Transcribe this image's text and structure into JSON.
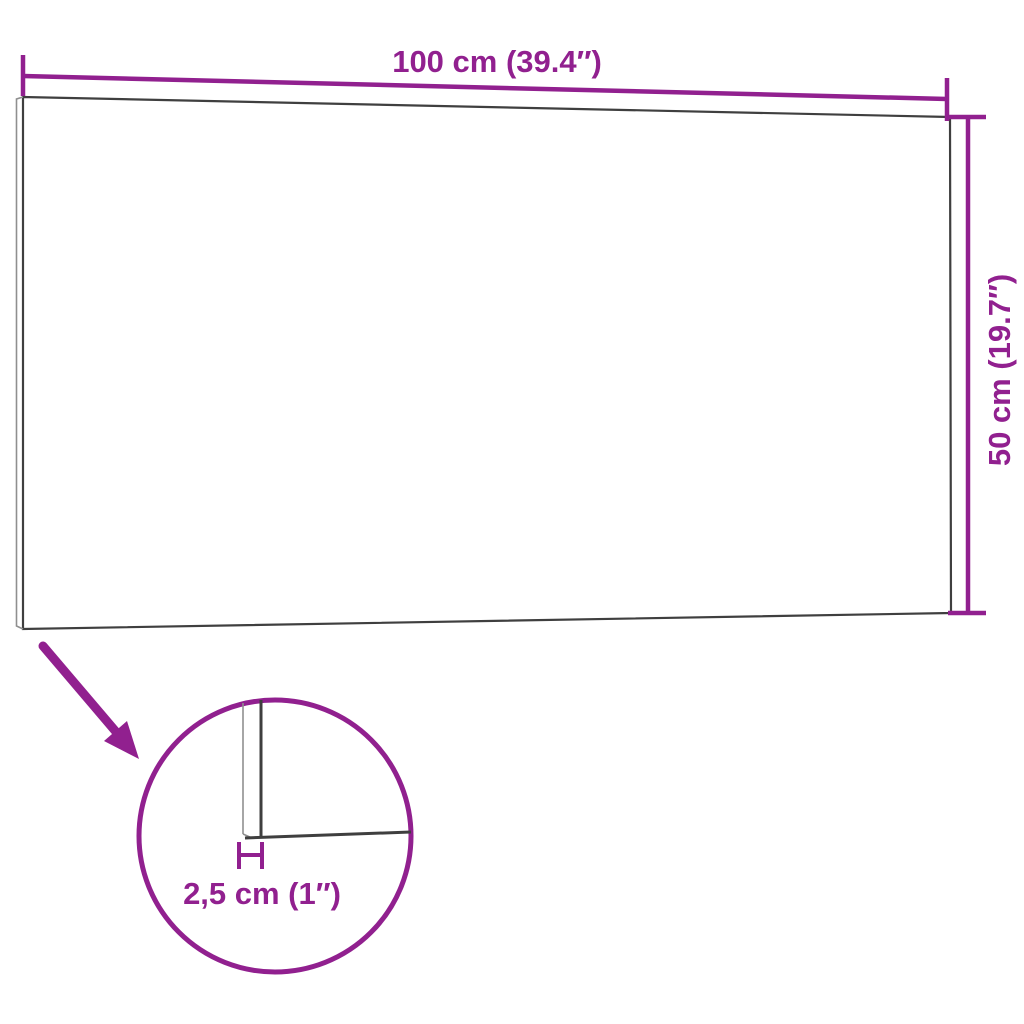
{
  "colors": {
    "accent": "#91208f",
    "panel_outline": "#3f3f3f",
    "panel_outline_light": "#8f8f8f",
    "background": "#ffffff"
  },
  "dimensions": {
    "width": {
      "label": "100 cm (39.4″)",
      "value_cm": "100",
      "value_inch": "39.4"
    },
    "height": {
      "label": "50 cm (19.7″)",
      "value_cm": "50",
      "value_inch": "19.7"
    },
    "thickness": {
      "label": "2,5 cm (1″)",
      "value_cm": "2,5",
      "value_inch": "1"
    }
  }
}
